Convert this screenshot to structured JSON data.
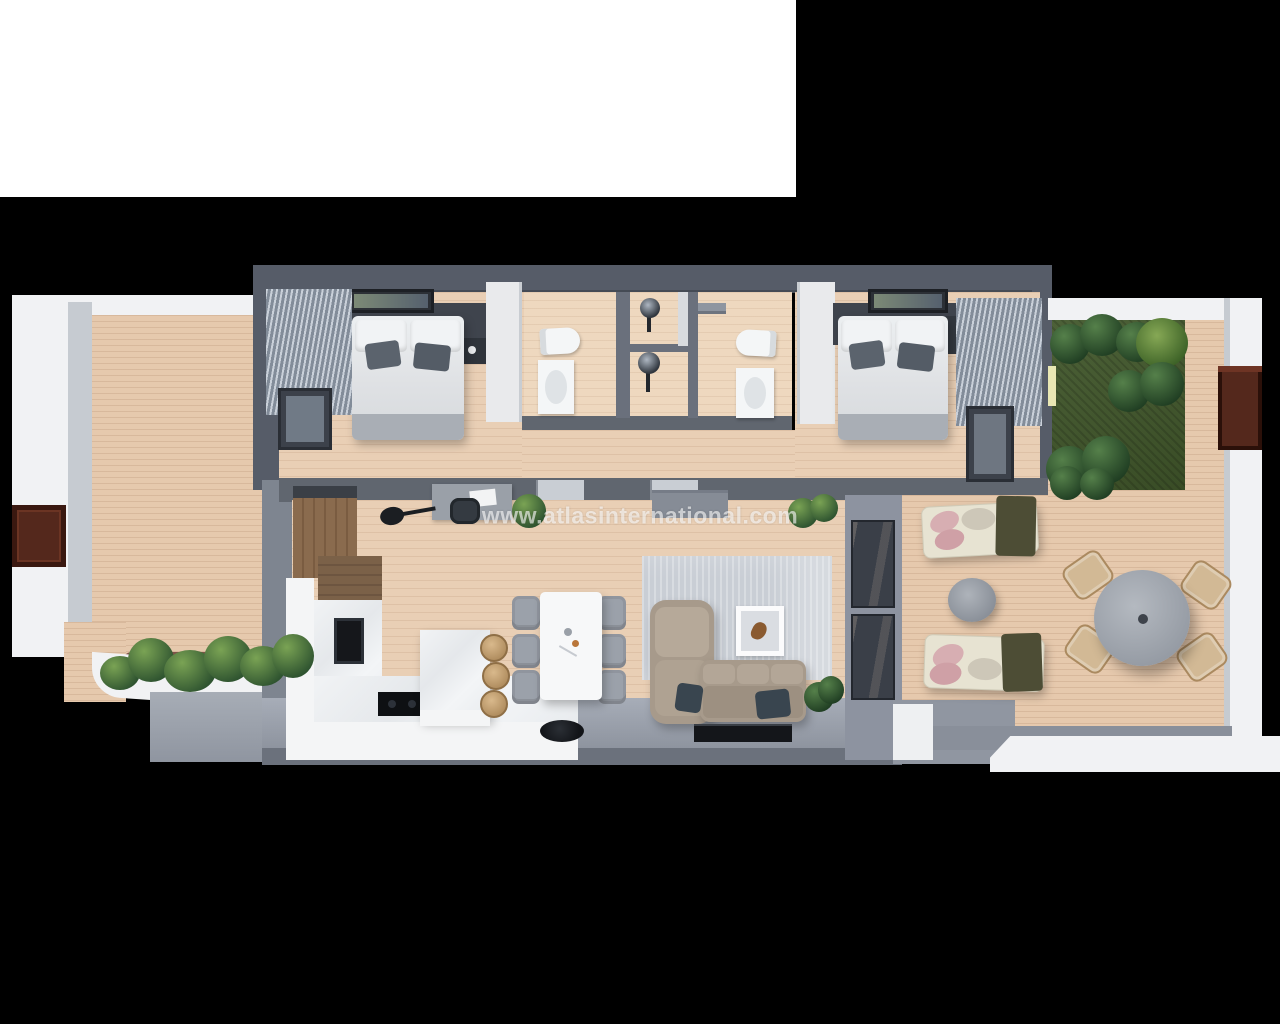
{
  "image": {
    "type": "3d-floor-plan-render",
    "view": "top-down",
    "subject": "Two-bedroom apartment with kitchen-living room, two bathrooms, two terraces and private lawn garden"
  },
  "watermark": {
    "text": "www.atlasinternational.com"
  },
  "colors": {
    "background": "#000000",
    "page-white": "#ffffff",
    "wall-dark": "#565c68",
    "wall-mid": "#7e8590",
    "wall-light": "#9aa0ab",
    "floor-wood": "#e9cfb5",
    "deck-wood": "#e6c9ad",
    "grass": "#41572b",
    "parapet-white": "#f1f2f4",
    "parapet-inner": "#c6cbd1",
    "marble": "#eceef0",
    "wood-cabinet": "#8a6b4e",
    "appliance-black": "#15171b",
    "sofa-beige": "#a79a8b",
    "rug-grey": "#c9ced5",
    "pillow-grey": "#5b636d",
    "blanket-grey": "#a9aeb5",
    "door-brown": "#54281c",
    "lounger-cream": "#e7e3d2",
    "pillow-pink": "#d7aeb2",
    "blanket-olive": "#4d4d35",
    "table-grey": "#a2a7ae",
    "wicker-tan": "#d2b995",
    "glass-dark": "#3a3f48",
    "pavement-grey": "#a7adb6"
  },
  "floorplan": {
    "rooms": [
      "bedroom-1",
      "bathroom-1",
      "bathroom-2",
      "bedroom-2",
      "hallway",
      "kitchen",
      "dining-area",
      "living-room",
      "left-terrace",
      "right-terrace",
      "garden"
    ],
    "furniture": {
      "bedroom-1": [
        "double-bed",
        "white-pillows",
        "grey-cushions",
        "headboard-wall",
        "nightstands",
        "wall-art",
        "window-blinds",
        "wardrobe"
      ],
      "bathroom-1": [
        "toilet",
        "washbasin-vanity",
        "walk-in-shower"
      ],
      "bathroom-2": [
        "toilet",
        "washbasin-vanity",
        "walk-in-shower",
        "rain-shower-arm"
      ],
      "bedroom-2": [
        "double-bed",
        "white-pillows",
        "grey-cushions",
        "headboard-wall",
        "side-cabinet",
        "wall-art",
        "window-blinds",
        "wardrobe"
      ],
      "kitchen": [
        "tall-wood-cabinets",
        "l-shaped-counter",
        "marble-worktop",
        "sink",
        "cooktop",
        "island",
        "bar-stools"
      ],
      "dining-area": [
        "white-dining-table",
        "six-grey-chairs"
      ],
      "living-room": [
        "corner-sofa",
        "navy-cushions",
        "area-rug",
        "framed-art",
        "tv",
        "desk",
        "desk-chair",
        "guitar",
        "sideboard",
        "potted-plants",
        "round-speaker"
      ],
      "left-terrace": [
        "wood-deck",
        "white-parapet",
        "brown-entry-door",
        "planter-with-plants",
        "pavement"
      ],
      "right-terrace": [
        "wood-deck",
        "two-sun-loungers",
        "pink-pillows",
        "olive-blankets",
        "round-side-table",
        "round-dining-table",
        "four-wicker-chairs",
        "potted-plant",
        "white-parapet"
      ],
      "garden": [
        "lawn",
        "tropical-plants",
        "palm-fern",
        "brown-pergola-door",
        "deck-border"
      ]
    }
  }
}
